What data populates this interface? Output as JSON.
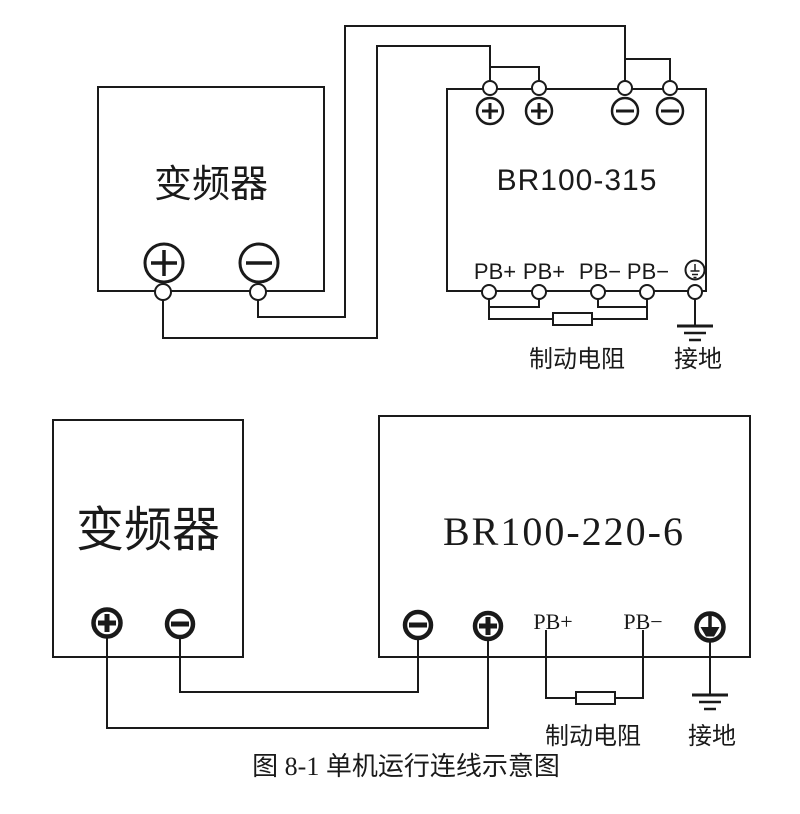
{
  "caption": "图 8-1 单机运行连线示意图",
  "colors": {
    "line": "#1a1a1a",
    "background": "#ffffff"
  },
  "top_diagram": {
    "inverter": {
      "label": "变频器",
      "terminal_plus": "+",
      "terminal_minus": "−"
    },
    "brake_unit": {
      "model": "BR100-315",
      "top_terminals": [
        "+",
        "+",
        "−",
        "−"
      ],
      "pb_terminals": [
        "PB+",
        "PB+",
        "PB−",
        "PB−"
      ]
    },
    "resistor_label": "制动电阻",
    "ground_label": "接地"
  },
  "bottom_diagram": {
    "inverter": {
      "label": "变频器",
      "terminal_plus": "+",
      "terminal_minus": "−"
    },
    "brake_unit": {
      "model": "BR100-220-6",
      "pb_plus": "PB+",
      "pb_minus": "PB−"
    },
    "resistor_label": "制动电阻",
    "ground_label": "接地"
  }
}
